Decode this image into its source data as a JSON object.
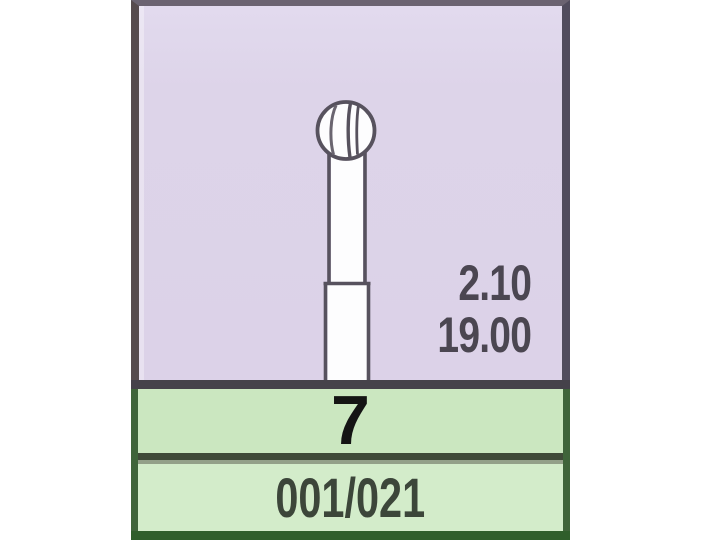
{
  "card": {
    "spec_panel": {
      "dimension_value_top": "2.10",
      "dimension_value_bottom": "19.00"
    },
    "shape_number": "7",
    "iso_size_code": "001/021",
    "diagram_icon": "round-ball-bur-icon",
    "colors": {
      "panel_background": "#dcd2e8",
      "shape_band_background": "#cbe7c0",
      "iso_band_background": "#d3ecca",
      "green_border": "#3f643a",
      "bottom_border": "#2f5e2b",
      "diagram_outline": "#57525e",
      "dimension_text": "#4b4651",
      "shape_number_text": "#141414",
      "iso_code_text": "#3c463a"
    }
  }
}
